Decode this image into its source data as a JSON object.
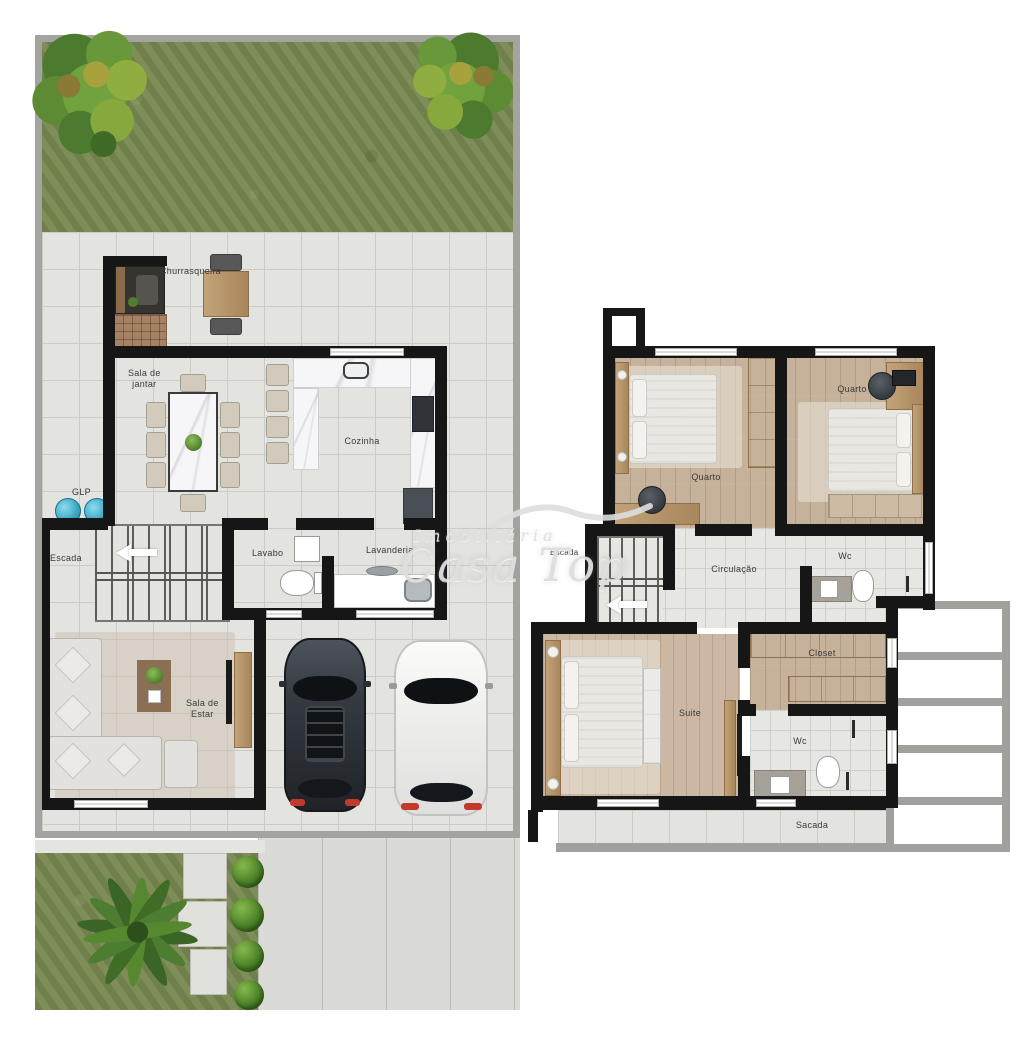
{
  "title": "Duplex house floor plan",
  "watermark": {
    "agency_prefix": "Imobiliária",
    "brand": "Casa Top"
  },
  "ground_floor": {
    "churrasqueira": "Churrasqueira",
    "sala_de_jantar": [
      "Sala de",
      "jantar"
    ],
    "glp": "GLP",
    "cozinha": "Cozinha",
    "escada": "Escada",
    "lavabo": "Lavabo",
    "lavanderia": "Lavanderia",
    "sala_de_estar": [
      "Sala de",
      "Estar"
    ]
  },
  "upper_floor": {
    "quarto_left": "Quarto",
    "quarto_right": "Quarto",
    "escada": "Escada",
    "circulacao": "Circulação",
    "wc_top": "Wc",
    "closet": "Closet",
    "suite": "Suite",
    "wc_bottom": "Wc",
    "sacada": "Sacada"
  },
  "colors": {
    "wall": "#161616",
    "tile_floor": "#e3e3df",
    "wood_floor": "#c6b29b",
    "grass": "#7e8c58",
    "glp_cylinder": "#3aa6c4",
    "frame_grey": "#a3a3a0"
  }
}
